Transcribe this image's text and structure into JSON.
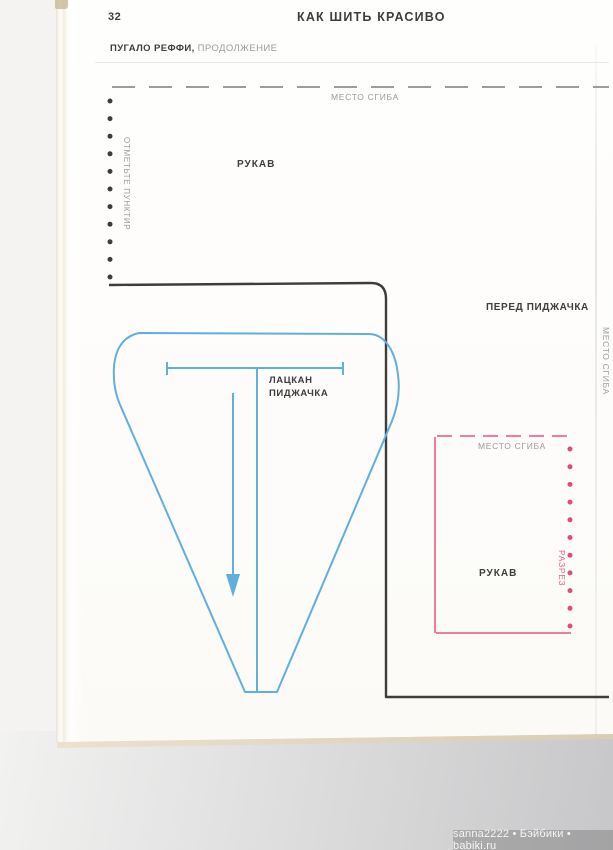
{
  "header": {
    "page_number": "32",
    "magazine_title": "КАК ШИТЬ КРАСИВО",
    "article_title": "ПУГАЛО РЕФФИ,",
    "article_subtitle": " ПРОДОЛЖЕНИЕ"
  },
  "pattern_labels": {
    "fold_top": "МЕСТО СГИБА",
    "mark_dotted": "ОТМЕТЬТЕ ПУНКТИР",
    "sleeve_top": "РУКАВ",
    "jacket_front": "ПЕРЕД ПИДЖАЧКА",
    "fold_right": "МЕСТО СГИБА",
    "lapel_line1": "ЛАЦКАН",
    "lapel_line2": "ПИДЖАЧКА",
    "fold_sleeve_box": "МЕСТО СГИБА",
    "sleeve_bottom": "РУКАВ",
    "cut": "РАЗРЕЗ"
  },
  "colors": {
    "blue": "#62aedd",
    "pink": "#ec7f9e",
    "pinkdot": "#dc4d7d",
    "pinktext": "#e0628c",
    "dark": "#3d3d3b",
    "gray": "#9b9b98"
  },
  "watermark": {
    "text": "sanna2222 • Бэйбики • babiki.ru"
  }
}
